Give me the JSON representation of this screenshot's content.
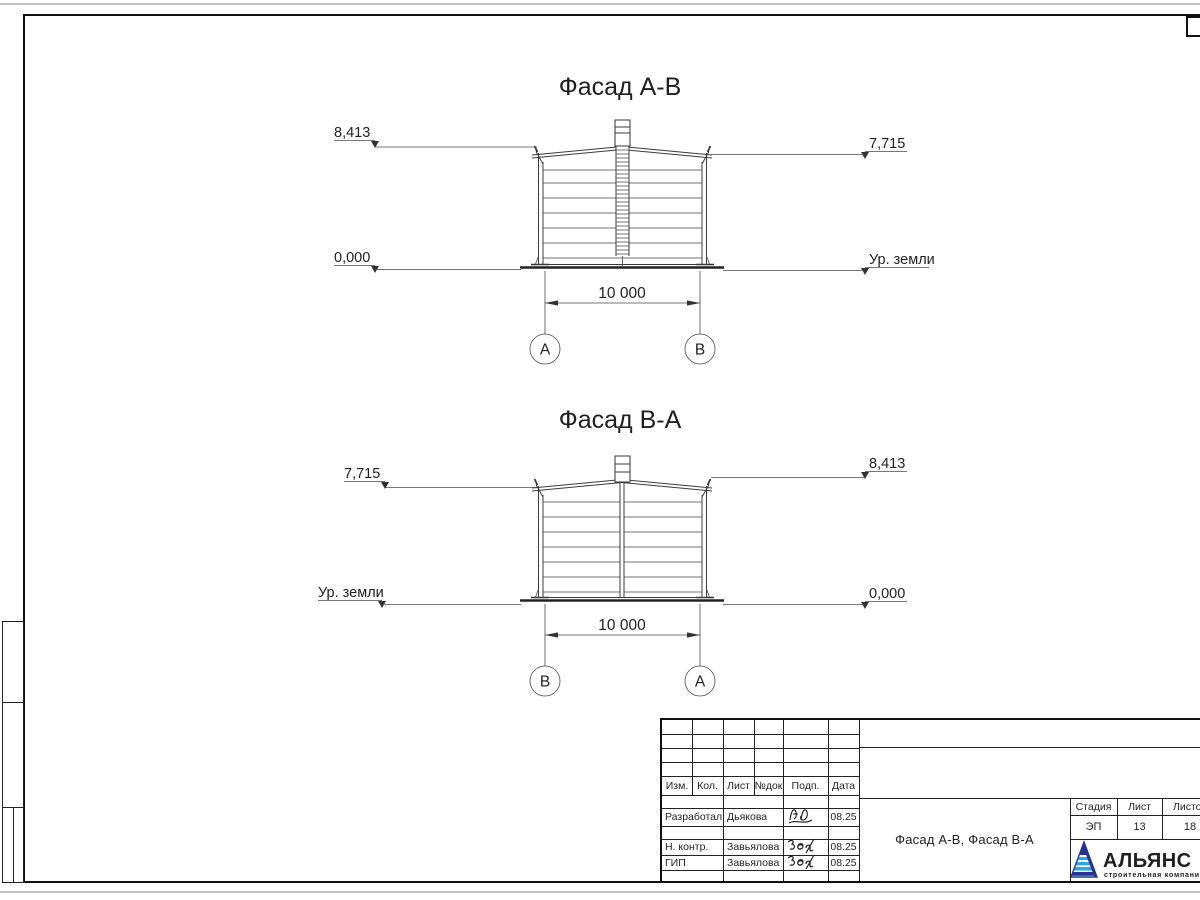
{
  "drawing": {
    "facade1": {
      "title": "Фасад А-В",
      "elev_top_left": "8,413",
      "elev_top_right": "7,715",
      "elev_bottom_left": "0,000",
      "elev_bottom_right": "Ур. земли",
      "dim_width": "10 000",
      "axis_left": "А",
      "axis_right": "В"
    },
    "facade2": {
      "title": "Фасад В-А",
      "elev_top_left": "7,715",
      "elev_top_right": "8,413",
      "elev_bottom_left": "Ур. земли",
      "elev_bottom_right": "0,000",
      "dim_width": "10 000",
      "axis_left": "В",
      "axis_right": "А"
    }
  },
  "title_block": {
    "revision_header": [
      "Изм.",
      "Кол.",
      "Лист",
      "№док",
      "Подп.",
      "Дата"
    ],
    "signature_rows": [
      {
        "role": "Разработал",
        "name": "Дьякова",
        "date": "08.25"
      },
      {
        "role": "Н. контр.",
        "name": "Завьялова",
        "date": "08.25"
      },
      {
        "role": "ГИП",
        "name": "Завьялова",
        "date": "08.25"
      }
    ],
    "doc_title": "Фасад А-В, Фасад В-А",
    "stage": {
      "label": "Стадия",
      "value": "ЭП"
    },
    "sheet": {
      "label": "Лист",
      "value": "13"
    },
    "sheets_total": {
      "label": "Листов",
      "value": "18"
    },
    "logo": {
      "company": "АЛЬЯНС",
      "tagline": "строительная компания",
      "navy": "#26358c",
      "cyan": "#2ea8dc"
    }
  }
}
